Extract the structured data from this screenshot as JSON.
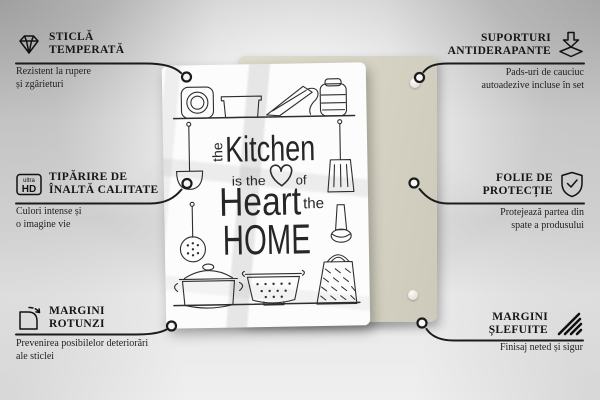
{
  "colors": {
    "line": "#1b1b1b",
    "back_panel": "#d5d2c3",
    "front_panel": "#fcfcfc",
    "background_gray": "#d6d6d6"
  },
  "features": {
    "tl": {
      "icon": "diamond-icon",
      "t1": "STICLĂ",
      "t2": "TEMPERATĂ",
      "d1": "Rezistent la rupere",
      "d2": "și zgârieturi"
    },
    "tr": {
      "icon": "anti-slip-pads-icon",
      "t1": "SUPORTURI",
      "t2": "ANTIDERAPANTE",
      "d1": "Pads-uri de cauciuc",
      "d2": "autoadezive incluse în set"
    },
    "ml": {
      "icon": "ultra-hd-icon",
      "icon_text_small": "ultra",
      "icon_text_big": "HD",
      "t1": "TIPĂRIRE DE",
      "t2": "ÎNALTĂ CALITATE",
      "d1": "Culori intense și",
      "d2": "o imagine vie"
    },
    "mr": {
      "icon": "shield-check-icon",
      "t1": "FOLIE DE",
      "t2": "PROTECȚIE",
      "d1": "Protejează partea din",
      "d2": "spate a produsului"
    },
    "bl": {
      "icon": "rounded-corner-icon",
      "t1": "MARGINI",
      "t2": "ROTUNZI",
      "d1": "Prevenirea posibilelor deteriorări",
      "d2": "ale sticlei"
    },
    "br": {
      "icon": "polished-edge-icon",
      "t1": "MARGINI",
      "t2": "ȘLEFUITE",
      "d1": "Finisaj neted și sigur",
      "d2": ""
    }
  },
  "artwork": {
    "the1": "the",
    "line1": "Kitchen",
    "small1": "is the",
    "small2": "of",
    "line2": "Heart",
    "the2": "the",
    "line3": "HOME"
  }
}
